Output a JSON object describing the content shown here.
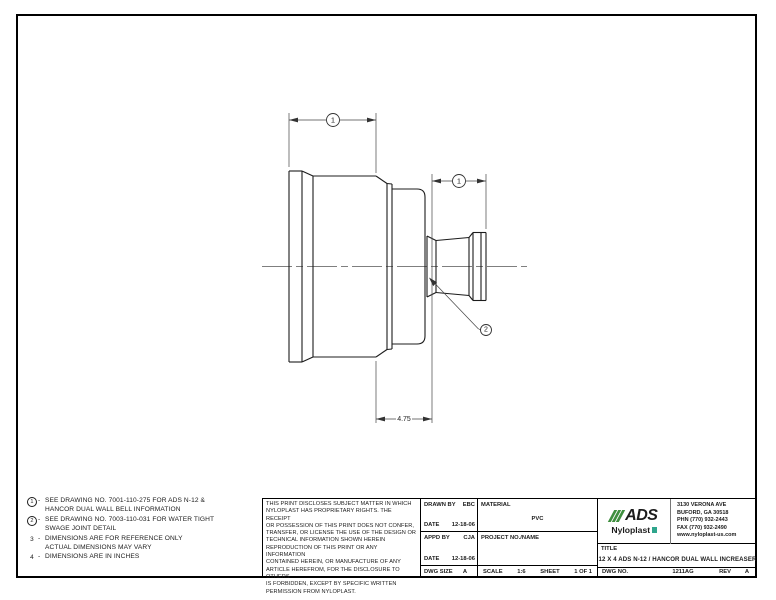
{
  "drawing": {
    "balloon1": "1",
    "balloon2": "2",
    "dim_475": "4.75"
  },
  "notes": {
    "items": [
      {
        "num": "1",
        "sep": "-",
        "line1": "SEE DRAWING NO. 7001-110-275 FOR ADS N-12 &",
        "line2": "HANCOR DUAL WALL BELL INFORMATION"
      },
      {
        "num": "2",
        "sep": "-",
        "line1": "SEE DRAWING NO. 7003-110-031 FOR WATER TIGHT",
        "line2": "SWAGE JOINT DETAIL"
      },
      {
        "num": "3",
        "sep": "-",
        "line1": "DIMENSIONS ARE FOR REFERENCE ONLY",
        "line2": "ACTUAL DIMENSIONS MAY VARY"
      },
      {
        "num": "4",
        "sep": "-",
        "line1": "DIMENSIONS ARE IN INCHES",
        "line2": ""
      }
    ]
  },
  "disclaimer": {
    "lines": [
      "THIS PRINT DISCLOSES SUBJECT MATTER IN WHICH",
      "NYLOPLAST HAS PROPRIETARY RIGHTS.  THE RECEIPT",
      "OR POSSESSION OF THIS PRINT DOES NOT CONFER,",
      "TRANSFER, OR LICENSE THE USE OF THE DESIGN OR",
      "TECHNICAL INFORMATION SHOWN HEREIN",
      "REPRODUCTION OF THIS PRINT OR ANY INFORMATION",
      "CONTAINED HEREIN, OR MANUFACTURE OF ANY",
      "ARTICLE HEREFROM, FOR THE DISCLOSURE TO OTHERS",
      "IS FORBIDDEN, EXCEPT BY SPECIFIC WRITTEN",
      "PERMISSION FROM NYLOPLAST."
    ]
  },
  "title_block": {
    "drawn_by_label": "DRAWN BY",
    "drawn_by": "EBC",
    "date_label": "DATE",
    "drawn_date": "12-18-06",
    "appd_by_label": "APPD BY",
    "appd_by": "CJA",
    "appd_date": "12-18-06",
    "material_label": "MATERIAL",
    "material": "PVC",
    "project_label": "PROJECT NO./NAME",
    "dwg_size_label": "DWG SIZE",
    "dwg_size": "A",
    "scale_label": "SCALE",
    "scale": "1:6",
    "sheet_label": "SHEET",
    "sheet": "1 OF 1",
    "title_label": "TITLE",
    "title": "12 X 4 ADS N-12 / HANCOR DUAL WALL INCREASER",
    "dwg_no_label": "DWG NO.",
    "dwg_no": "1211AG",
    "rev_label": "REV",
    "rev": "A"
  },
  "company": {
    "ads": "ADS",
    "nyloplast": "Nyloplast",
    "green": "#3f8f3f",
    "teal": "#2fa58c",
    "address_lines": [
      "3130 VERONA AVE",
      "BUFORD, GA 30518",
      "PHN (770) 932-2443",
      "FAX (770) 932-2490",
      "www.nyloplast-us.com"
    ]
  }
}
